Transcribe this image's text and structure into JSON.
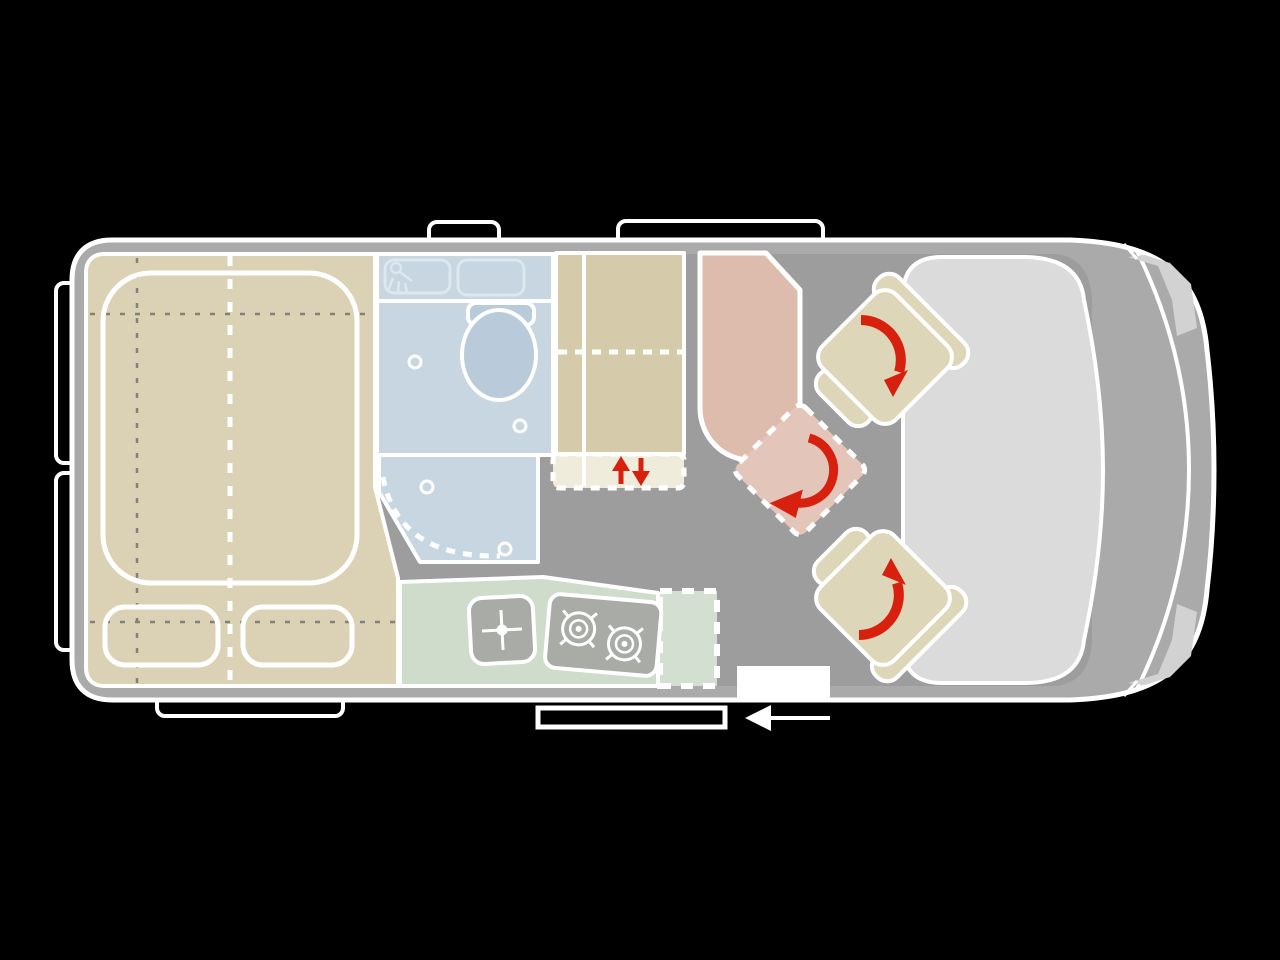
{
  "diagram": {
    "kind": "campervan-floorplan-top-view",
    "vehicle_front": "right",
    "vehicle_rear": "left"
  },
  "colors": {
    "background": "#000000",
    "body": "#aaaaaa",
    "floor": "#9d9d9d",
    "outline": "#ffffff",
    "bed": "#dbd1b4",
    "wardrobe": "#d5caa9",
    "cream": "#f0ecdb",
    "bathroom": "#c8d6e2",
    "fixture": "#b9cbda",
    "fixture_stroke": "#dce7ee",
    "table": "#ddbcae",
    "table_ext": "#e3c6b9",
    "seat": "#ded6b8",
    "kitchen": "#cfdbcb",
    "kitchen_ext": "#d3dfd0",
    "appliance": "#a8aba6",
    "cab": "#dbdbdb",
    "headlight": "#d2d2d2",
    "accent": "#d8200f"
  },
  "zones": [
    {
      "id": "rear-bed",
      "name": "transverse double bed with two pillows"
    },
    {
      "id": "bathroom",
      "name": "wet bathroom with toilet and shower tray"
    },
    {
      "id": "wardrobe",
      "name": "wardrobe / cabinet column with lift section"
    },
    {
      "id": "dinette-table",
      "name": "table with folding extension flap"
    },
    {
      "id": "swivel-seats",
      "name": "two rotating cab seats"
    },
    {
      "id": "kitchen",
      "name": "kitchen block with sink, two-burner hob and worktop flap"
    },
    {
      "id": "cab",
      "name": "driver cab with windscreen and headlights"
    },
    {
      "id": "entry",
      "name": "sliding-door entry with step"
    }
  ],
  "icons": [
    "shower-head-icon",
    "toilet-icon",
    "drain-plug-icon",
    "sink-cross-icon",
    "stove-burner-icon",
    "rotation-arrow-icon",
    "up-down-arrows-icon",
    "slide-direction-arrow-icon"
  ],
  "annotations": {
    "seat_rotation": "both cab seats swivel toward the living area",
    "bed_lift": "red up/down arrows mark height-adjustable section",
    "door_slide": "white arrow shows sliding door opens toward front-left"
  }
}
